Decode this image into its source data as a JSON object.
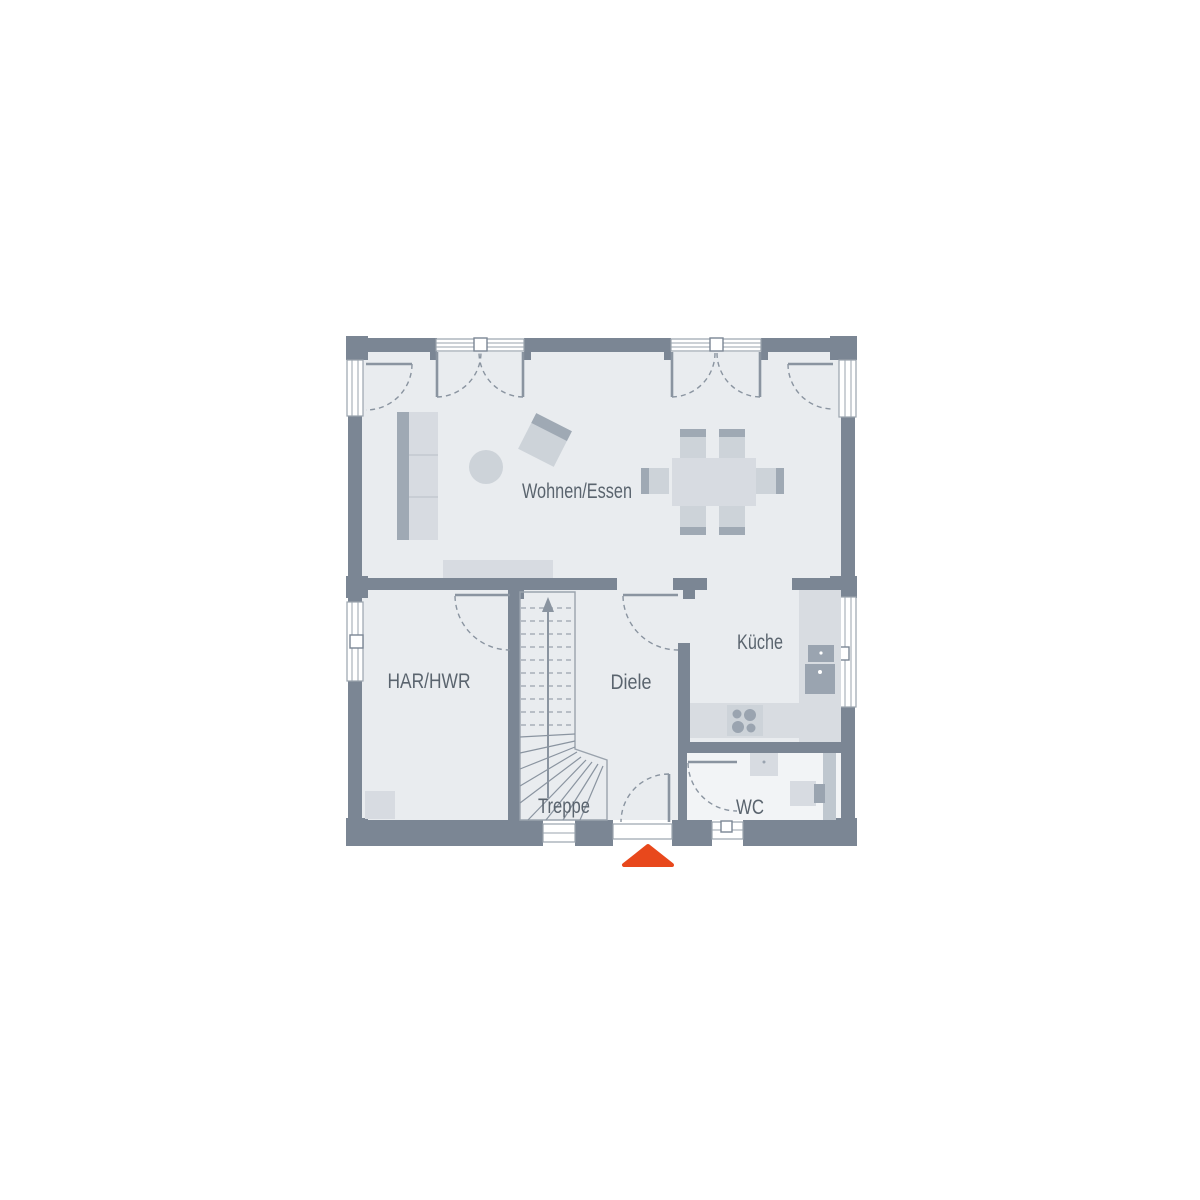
{
  "plan": {
    "type": "floor-plan",
    "floor": "Erdgeschoss"
  },
  "rooms": {
    "wohnen_essen": {
      "label": "Wohnen/Essen"
    },
    "har_hwr": {
      "label": "HAR/HWR"
    },
    "diele": {
      "label": "Diele"
    },
    "kueche": {
      "label": "Küche"
    },
    "treppe": {
      "label": "Treppe"
    },
    "wc": {
      "label": "WC"
    }
  },
  "colors": {
    "background": "#ffffff",
    "wall": "#7b8694",
    "floor": "#e9ecef",
    "floor_wc": "#f2f4f6",
    "furniture_light": "#d7dbe1",
    "furniture_mid": "#cdd3d9",
    "furniture_dark": "#9fa9b4",
    "appliance_dark": "#9aa4b0",
    "counter": "#d8dce1",
    "install_band": "#bfc7cf",
    "line": "#9aa3ad",
    "arc_line": "#8a94a0",
    "label_text": "#5a646e",
    "window_fill": "#ffffff",
    "entrance_marker": "#e8481c"
  }
}
